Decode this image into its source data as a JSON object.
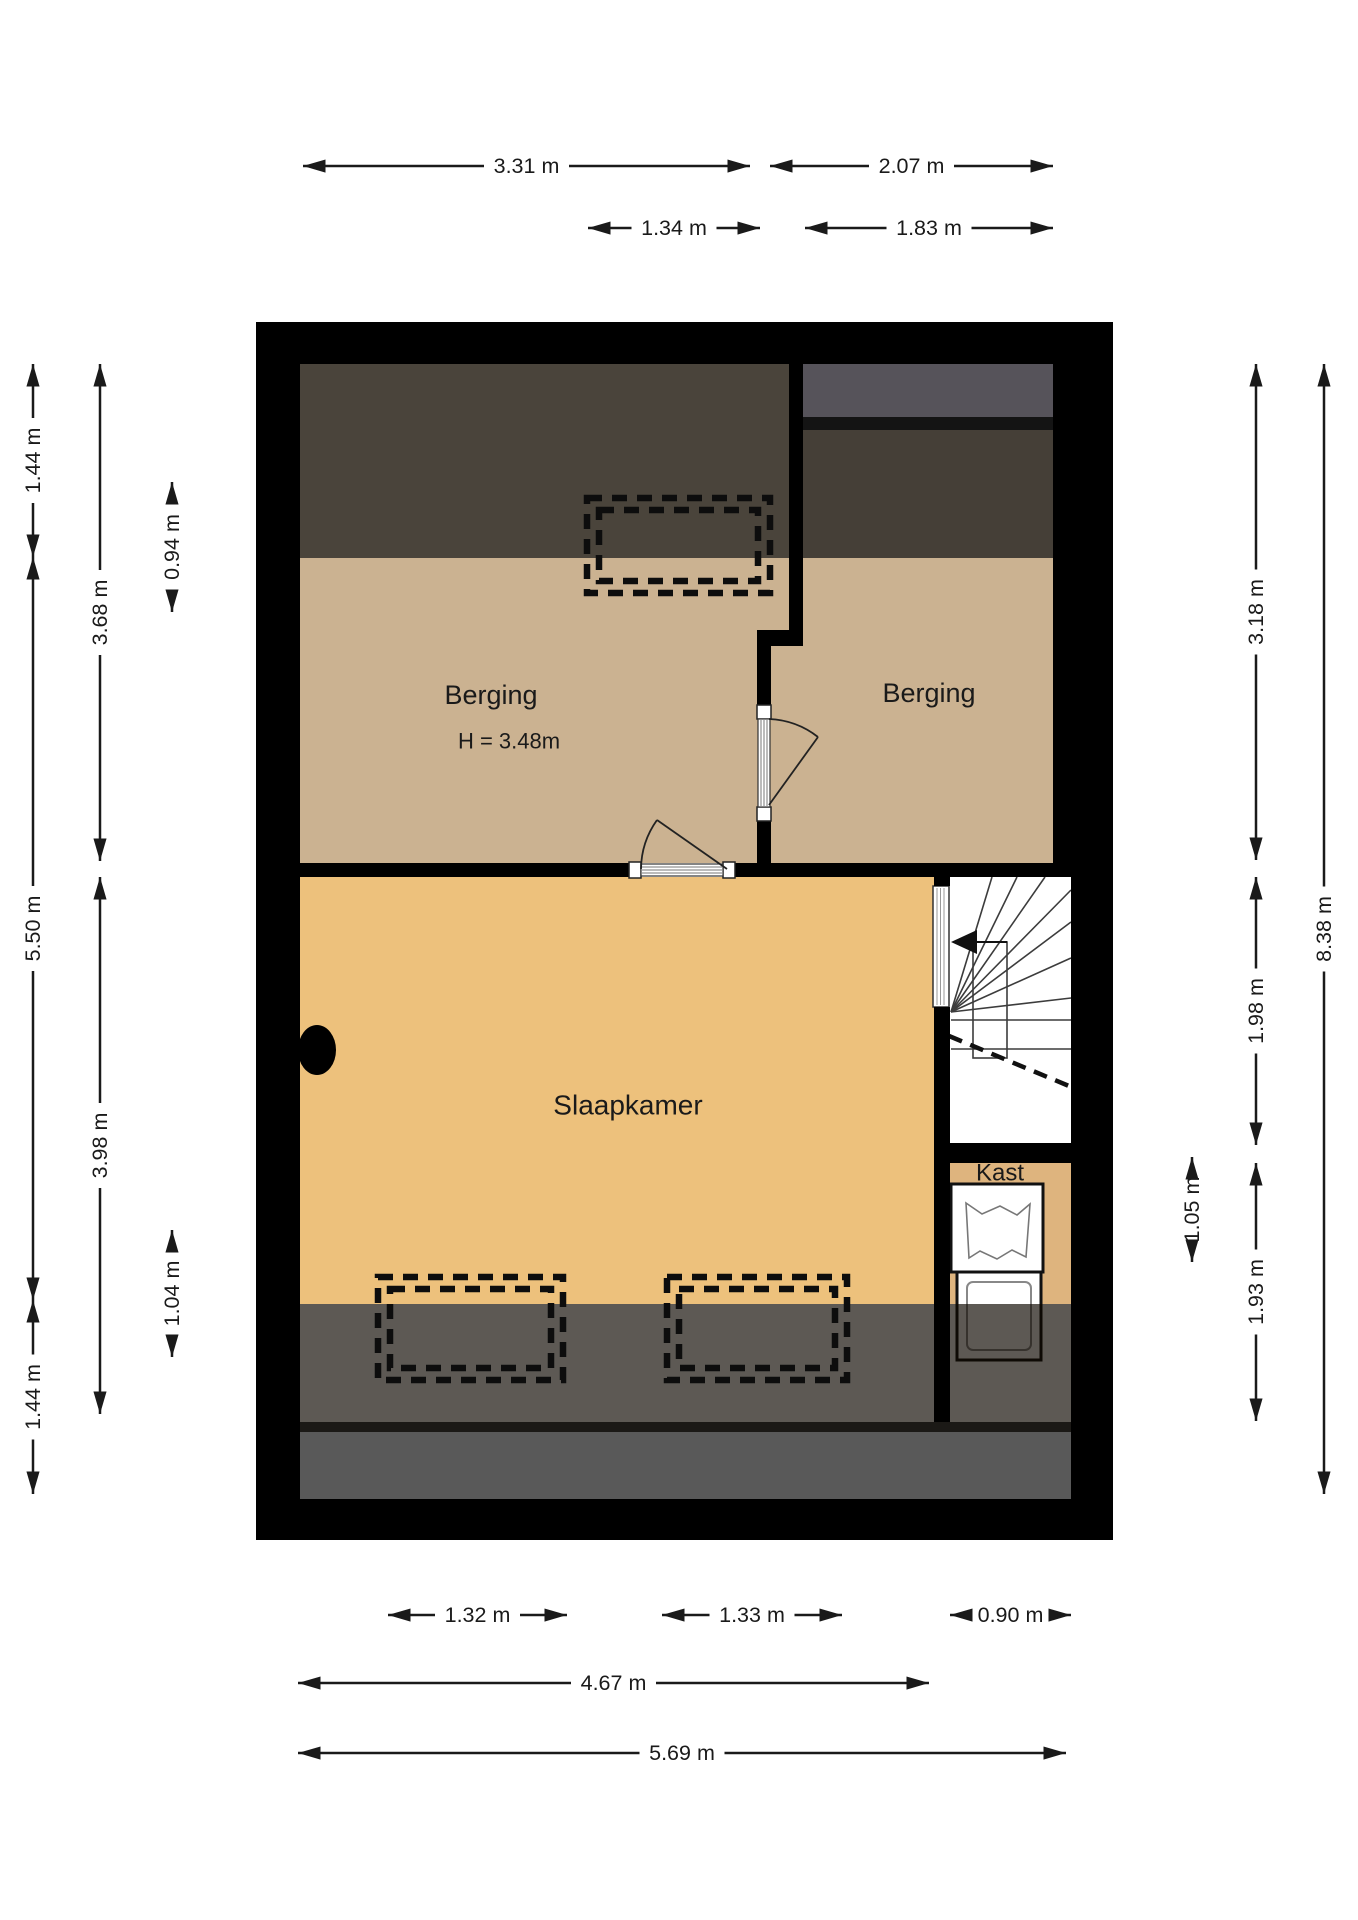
{
  "floorplan": {
    "rooms": {
      "berging_left": {
        "name": "Berging",
        "height": "H = 3.48m"
      },
      "berging_right": {
        "name": "Berging"
      },
      "slaapkamer": {
        "name": "Slaapkamer"
      },
      "kast": {
        "name": "Kast"
      }
    },
    "dims": {
      "top": [
        {
          "label": "3.31 m"
        },
        {
          "label": "2.07 m"
        },
        {
          "label": "1.34 m"
        },
        {
          "label": "1.83 m"
        }
      ],
      "bottom": [
        {
          "label": "1.32 m"
        },
        {
          "label": "1.33 m"
        },
        {
          "label": "0.90 m"
        },
        {
          "label": "4.67 m"
        },
        {
          "label": "5.69 m"
        }
      ],
      "left": [
        {
          "label": "1.44 m"
        },
        {
          "label": "5.50 m"
        },
        {
          "label": "1.44 m"
        },
        {
          "label": "3.68 m"
        },
        {
          "label": "3.98 m"
        },
        {
          "label": "0.94 m"
        },
        {
          "label": "1.04 m"
        }
      ],
      "right": [
        {
          "label": "1.05 m"
        },
        {
          "label": "3.18 m"
        },
        {
          "label": "1.98 m"
        },
        {
          "label": "1.93 m"
        },
        {
          "label": "8.38 m"
        }
      ]
    },
    "colors": {
      "wall": "#000000",
      "berging_floor": "#cbb291",
      "slaapkamer_floor": "#edc17c",
      "kast_floor": "#deb47e",
      "attic_shade_top": "#4a443b",
      "party_wall_gray": "#56535a",
      "bottom_shade": "#4a3e2d",
      "bottom_gray": "#595959",
      "stair_background": "#ffffff",
      "dimension_ink": "#1a1a1a"
    }
  }
}
